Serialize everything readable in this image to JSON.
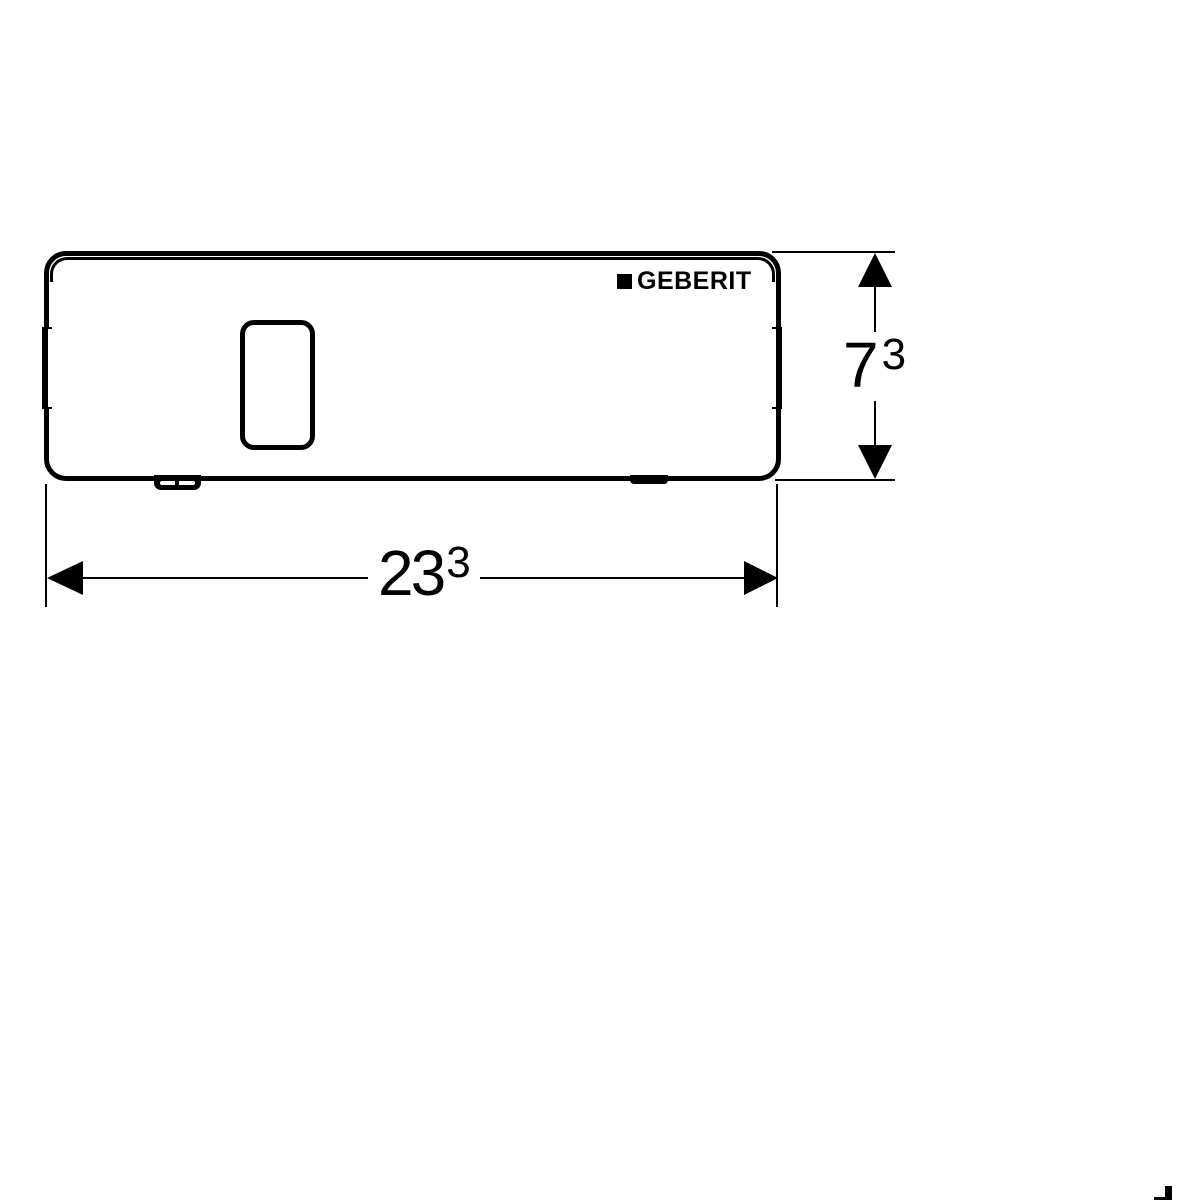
{
  "colors": {
    "line": "#000000",
    "background": "#ffffff"
  },
  "logo": {
    "text": "GEBERIT"
  },
  "dimensions": {
    "height": {
      "value": "7",
      "sup": "3"
    },
    "width": {
      "value": "23",
      "sup": "3"
    }
  }
}
